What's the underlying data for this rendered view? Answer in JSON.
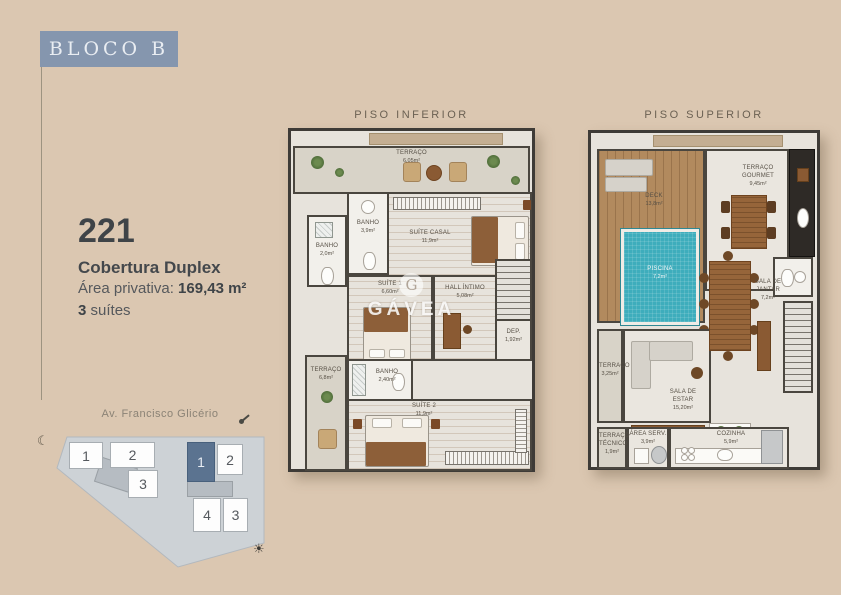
{
  "brand": {
    "bloco_label": "BLOCO B",
    "watermark": "GÁVEA",
    "watermark_initial": "G"
  },
  "unit": {
    "number": "221",
    "type": "Cobertura Duplex",
    "area_label": "Área privativa:",
    "area_value": "169,43 m²",
    "suites_count": "3",
    "suites_label": "suítes"
  },
  "plans": {
    "inferior": {
      "title": "PISO INFERIOR",
      "rooms": [
        {
          "name": "TERRAÇO",
          "area": "6,05m²"
        },
        {
          "name": "BANHO",
          "area": "3,9m²"
        },
        {
          "name": "SUÍTE CASAL",
          "area": "11,9m²"
        },
        {
          "name": "BANHO",
          "area": "2,0m²"
        },
        {
          "name": "SUÍTE 1",
          "area": "6,60m²"
        },
        {
          "name": "HALL ÍNTIMO",
          "area": "5,08m²"
        },
        {
          "name": "DEP.",
          "area": "1,92m²"
        },
        {
          "name": "BANHO",
          "area": "2,40m²"
        },
        {
          "name": "SUÍTE 2",
          "area": "11,9m²"
        },
        {
          "name": "TERRAÇO",
          "area": "6,8m²"
        }
      ]
    },
    "superior": {
      "title": "PISO SUPERIOR",
      "rooms": [
        {
          "name": "DECK",
          "area": "13,8m²"
        },
        {
          "name": "PISCINA",
          "area": "7,2m²"
        },
        {
          "name": "TERRAÇO\nGOURMET",
          "area": "9,45m²"
        },
        {
          "name": "SALA DE\nJANTAR",
          "area": "7,2m²"
        },
        {
          "name": "SALA DE\nESTAR",
          "area": "15,20m²"
        },
        {
          "name": "TERRAÇO",
          "area": "3,25m²"
        },
        {
          "name": "TERRAÇO\nTÉCNICO",
          "area": "1,9m²"
        },
        {
          "name": "ÁREA SERV.",
          "area": "3,9m²"
        },
        {
          "name": "COZINHA",
          "area": "5,9m²"
        }
      ]
    }
  },
  "site_plan": {
    "street": "Av. Francisco Glicério",
    "blocks_left": [
      "1",
      "2",
      "3"
    ],
    "blocks_right": [
      "1",
      "2",
      "4",
      "3"
    ],
    "icons": {
      "moon": "☾",
      "sun": "☀"
    }
  },
  "colors": {
    "background": "#dbc7b1",
    "badge": "#8596ae",
    "highlight_block": "#5b7390",
    "pool": "#3eadbc",
    "wood_floor": "#c9ad89",
    "deck_wood": "#b28a5e",
    "wall": "#3e3b37"
  }
}
